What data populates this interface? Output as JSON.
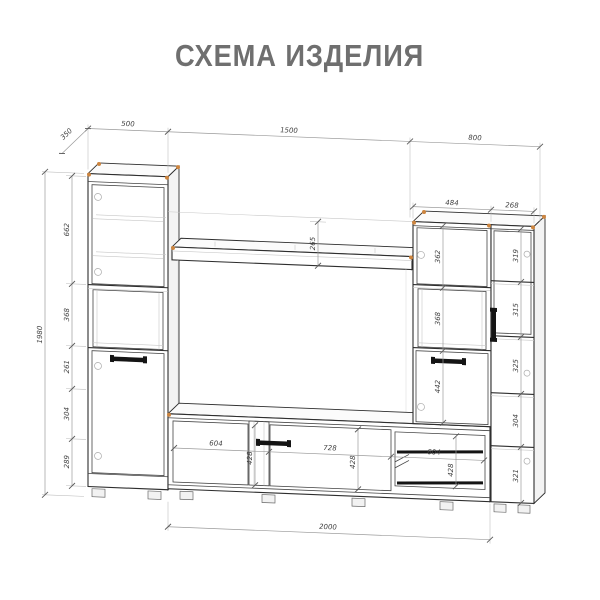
{
  "title": "СХЕМА ИЗДЕЛИЯ",
  "dimensions": {
    "depth": "350",
    "left_width": "500",
    "center_width": "1500",
    "right_width": "800",
    "total_height": "1980",
    "left_sections": [
      "662",
      "368",
      "261",
      "304",
      "289"
    ],
    "right_upper_width": "484",
    "right_side_width": "268",
    "right_center_sections": [
      "362",
      "368",
      "442"
    ],
    "right_side_sections": [
      "319",
      "315",
      "325",
      "304",
      "321"
    ],
    "shelf_height": "265",
    "stand_widths": [
      "604",
      "728",
      "604"
    ],
    "stand_heights": [
      "428",
      "428",
      "428"
    ],
    "stand_total_width": "2000"
  },
  "colors": {
    "line": "#2e2e2e",
    "dimension": "#9a9a9a",
    "corner_marker": "#cd853f",
    "title_gray": "#6f6f6f"
  }
}
